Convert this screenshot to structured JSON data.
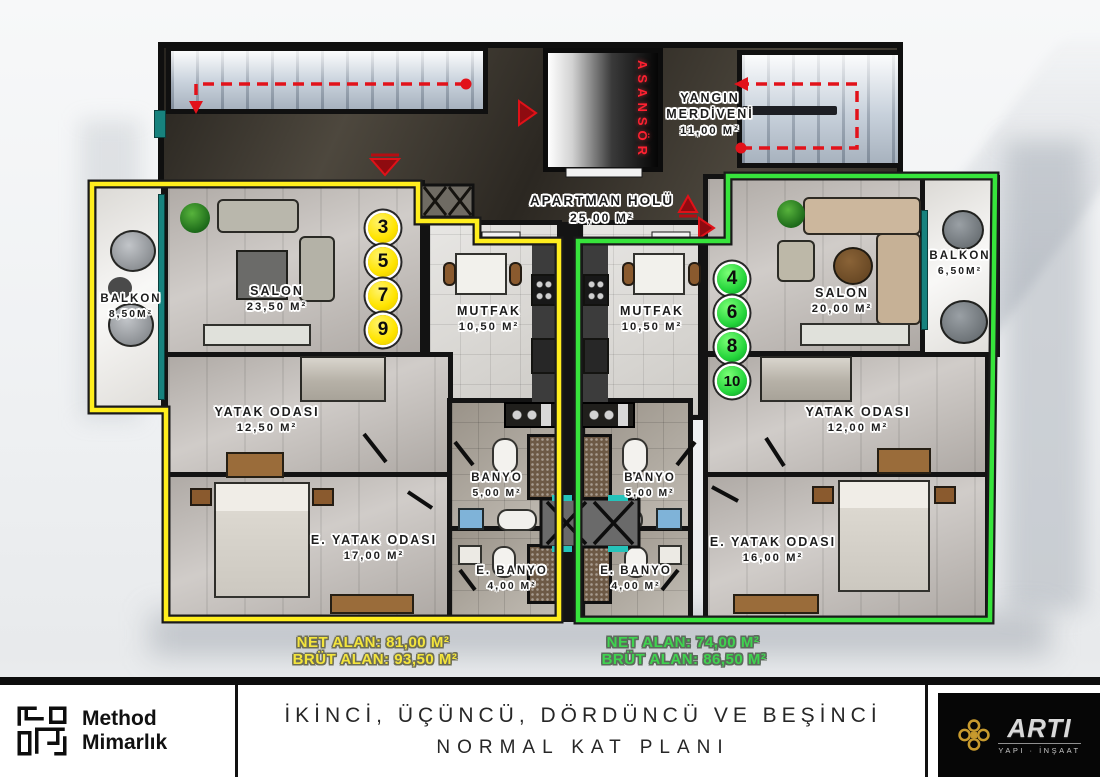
{
  "colors": {
    "unit_left_outline": "#ffee1e",
    "unit_right_outline": "#37e43c",
    "route_red": "#e2121a"
  },
  "core": {
    "elevator_label": "ASANSÖR",
    "fire_stairs": {
      "line1": "YANGIN",
      "line2": "MERDİVENİ",
      "area": "11,00 m²"
    },
    "hall": {
      "name": "APARTMAN HOLÜ",
      "area": "25,00 m²"
    }
  },
  "left_unit": {
    "numbers": [
      "3",
      "5",
      "7",
      "9"
    ],
    "rooms": {
      "balkon": {
        "name": "BALKON",
        "area": "8,50m²"
      },
      "salon": {
        "name": "SALON",
        "area": "23,50 m²"
      },
      "mutfak": {
        "name": "MUTFAK",
        "area": "10,50 m²"
      },
      "yatak": {
        "name": "YATAK ODASI",
        "area": "12,50 m²"
      },
      "e_yatak": {
        "name": "E. YATAK ODASI",
        "area": "17,00 m²"
      },
      "banyo": {
        "name": "BANYO",
        "area": "5,00 m²"
      },
      "e_banyo": {
        "name": "E. BANYO",
        "area": "4,00 m²"
      }
    },
    "summary": {
      "net": "NET ALAN: 81,00 M²",
      "brut": "BRÜT ALAN: 93,50 M²"
    }
  },
  "right_unit": {
    "numbers": [
      "4",
      "6",
      "8",
      "10"
    ],
    "rooms": {
      "balkon": {
        "name": "BALKON",
        "area": "6,50m²"
      },
      "salon": {
        "name": "SALON",
        "area": "20,00 m²"
      },
      "mutfak": {
        "name": "MUTFAK",
        "area": "10,50 m²"
      },
      "yatak": {
        "name": "YATAK ODASI",
        "area": "12,00 m²"
      },
      "e_yatak": {
        "name": "E. YATAK ODASI",
        "area": "16,00 m²"
      },
      "banyo": {
        "name": "BANYO",
        "area": "5,00 m²"
      },
      "e_banyo": {
        "name": "E. BANYO",
        "area": "4,00 m²"
      }
    },
    "summary": {
      "net": "NET ALAN: 74,00 M²",
      "brut": "BRÜT ALAN: 86,50 M²"
    }
  },
  "footer": {
    "studio": {
      "line1": "Method",
      "line2": "Mimarlık"
    },
    "title": {
      "line1": "İKİNCİ, ÜÇÜNCÜ, DÖRDÜNCÜ VE BEŞİNCİ",
      "line2": "NORMAL KAT PLANI"
    },
    "builder": {
      "name": "ARTI",
      "sub": "YAPI · İNŞAAT"
    }
  }
}
